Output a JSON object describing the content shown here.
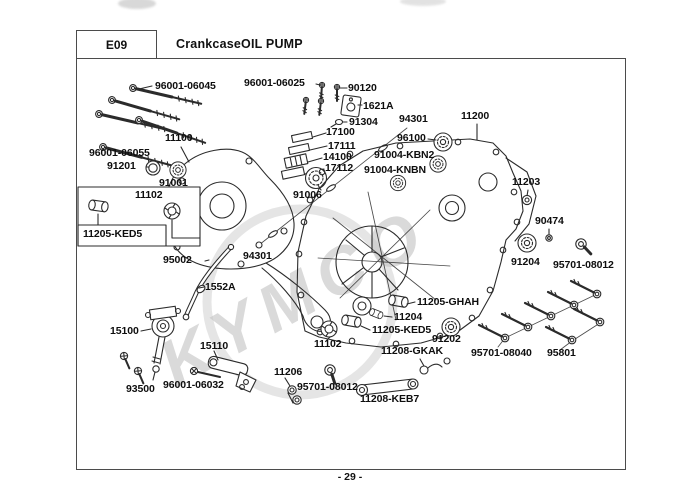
{
  "header": {
    "section_code": "E09",
    "title": "CrankcaseOIL PUMP"
  },
  "footer": {
    "page_number": "- 29 -"
  },
  "watermark": {
    "text": "KYMCO"
  },
  "colors": {
    "line": "#2b2b2b",
    "frame": "#4b4b4b",
    "watermark": "#b6b6b6",
    "background": "#ffffff"
  },
  "part_labels": [
    {
      "text": "96001-06045",
      "x": 155,
      "y": 80
    },
    {
      "text": "96001-06025",
      "x": 244,
      "y": 77
    },
    {
      "text": "90120",
      "x": 348,
      "y": 82
    },
    {
      "text": "1621A",
      "x": 363,
      "y": 100
    },
    {
      "text": "91304",
      "x": 349,
      "y": 116
    },
    {
      "text": "94301",
      "x": 399,
      "y": 113
    },
    {
      "text": "11200",
      "x": 461,
      "y": 110
    },
    {
      "text": "17100",
      "x": 326,
      "y": 126
    },
    {
      "text": "17111",
      "x": 328,
      "y": 140
    },
    {
      "text": "14100",
      "x": 323,
      "y": 151
    },
    {
      "text": "17112",
      "x": 325,
      "y": 162
    },
    {
      "text": "96100",
      "x": 397,
      "y": 132
    },
    {
      "text": "91004-KBN2",
      "x": 374,
      "y": 149
    },
    {
      "text": "91004-KNBN",
      "x": 364,
      "y": 164
    },
    {
      "text": "11100",
      "x": 165,
      "y": 132
    },
    {
      "text": "96001-06055",
      "x": 89,
      "y": 147
    },
    {
      "text": "91201",
      "x": 107,
      "y": 160
    },
    {
      "text": "91001",
      "x": 159,
      "y": 177
    },
    {
      "text": "11102",
      "x": 135,
      "y": 189
    },
    {
      "text": "11205-KED5",
      "x": 83,
      "y": 228
    },
    {
      "text": "91006",
      "x": 293,
      "y": 189
    },
    {
      "text": "95002",
      "x": 163,
      "y": 254
    },
    {
      "text": "1552A",
      "x": 205,
      "y": 281
    },
    {
      "text": "94301",
      "x": 243,
      "y": 250
    },
    {
      "text": "11203",
      "x": 512,
      "y": 176
    },
    {
      "text": "90474",
      "x": 535,
      "y": 215
    },
    {
      "text": "91204",
      "x": 511,
      "y": 256
    },
    {
      "text": "95701-08012",
      "x": 553,
      "y": 259
    },
    {
      "text": "11205-GHAH",
      "x": 417,
      "y": 296
    },
    {
      "text": "11204",
      "x": 394,
      "y": 311
    },
    {
      "text": "11205-KED5",
      "x": 372,
      "y": 324
    },
    {
      "text": "91202",
      "x": 432,
      "y": 333
    },
    {
      "text": "11102",
      "x": 314,
      "y": 338
    },
    {
      "text": "11208-GKAK",
      "x": 381,
      "y": 345
    },
    {
      "text": "95701-08040",
      "x": 471,
      "y": 347
    },
    {
      "text": "95801",
      "x": 547,
      "y": 347
    },
    {
      "text": "15100",
      "x": 110,
      "y": 325
    },
    {
      "text": "15110",
      "x": 200,
      "y": 340
    },
    {
      "text": "93500",
      "x": 126,
      "y": 383
    },
    {
      "text": "96001-06032",
      "x": 163,
      "y": 379
    },
    {
      "text": "11206",
      "x": 274,
      "y": 366
    },
    {
      "text": "95701-08012",
      "x": 297,
      "y": 381
    },
    {
      "text": "11208-KEB7",
      "x": 360,
      "y": 393
    }
  ]
}
